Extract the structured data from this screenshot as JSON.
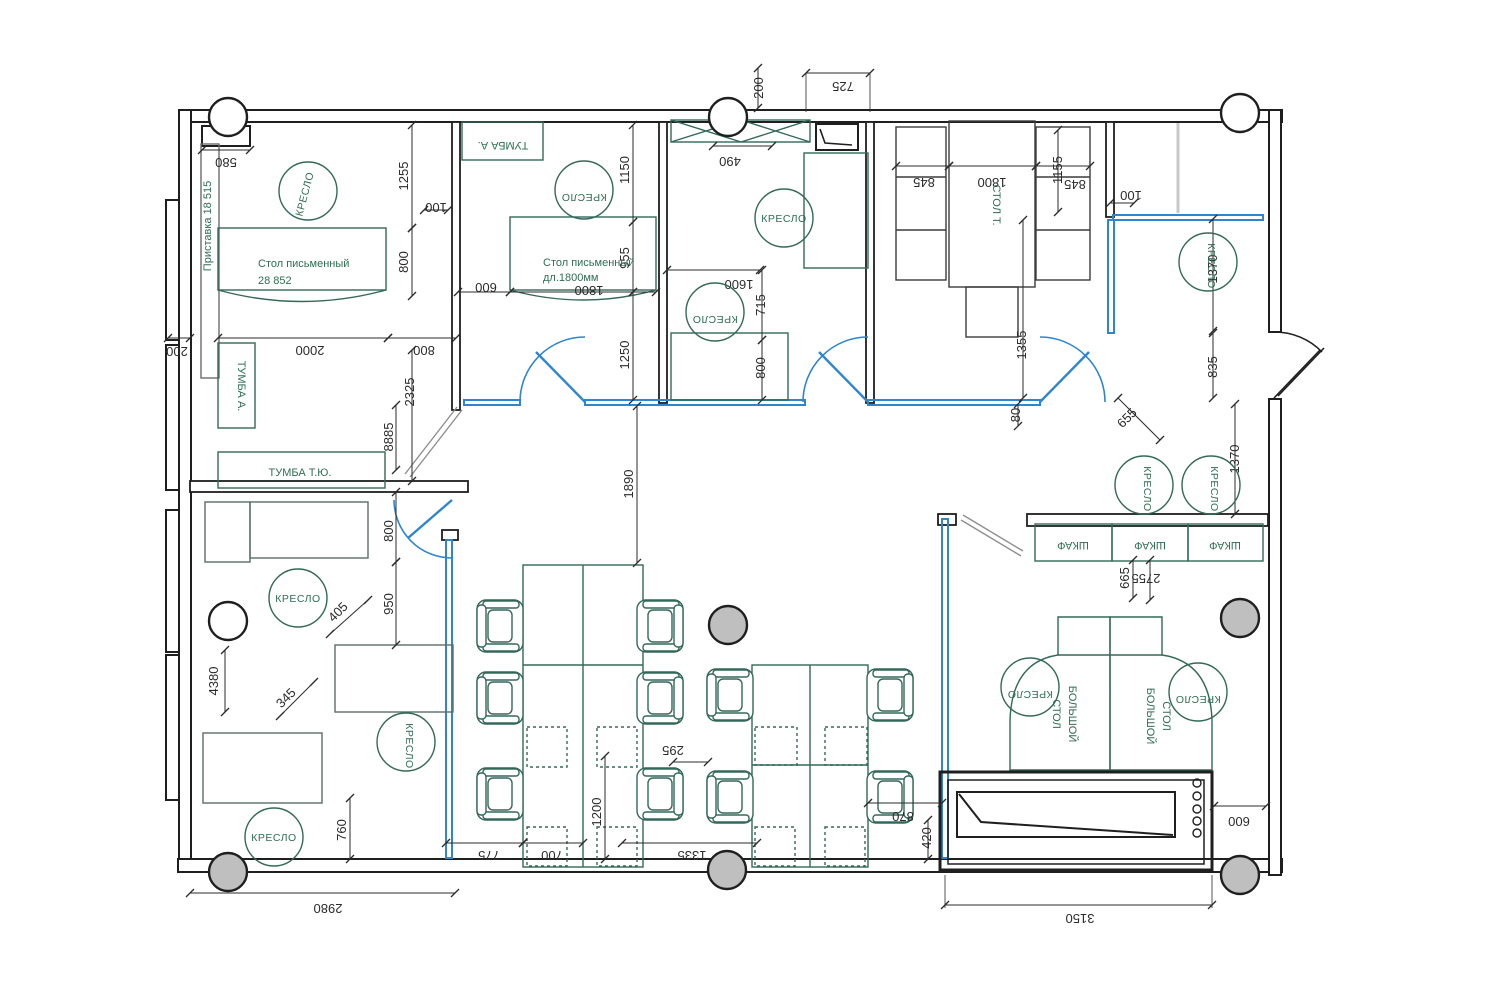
{
  "colors": {
    "wall": "#1f1f1f",
    "partition_blue": "#2f86cf",
    "furniture_green": "#33695a",
    "label_green": "#2f6e54",
    "dim_black": "#2b2b2b",
    "column_gray": "#bfbfbf",
    "light_gray": "#c9c9c9"
  },
  "chair_symbol_label": "КРЕСЛО",
  "chairs": [
    {
      "x": 308,
      "y": 191,
      "rot": -75
    },
    {
      "x": 584,
      "y": 190,
      "rot": 180
    },
    {
      "x": 784,
      "y": 218,
      "rot": 0
    },
    {
      "x": 715,
      "y": 312,
      "rot": 180
    },
    {
      "x": 1208,
      "y": 262,
      "rot": 90
    },
    {
      "x": 1144,
      "y": 485,
      "rot": 90
    },
    {
      "x": 1211,
      "y": 485,
      "rot": 90
    },
    {
      "x": 298,
      "y": 598,
      "rot": 0
    },
    {
      "x": 406,
      "y": 742,
      "rot": 90
    },
    {
      "x": 274,
      "y": 837,
      "rot": 0
    },
    {
      "x": 1030,
      "y": 687,
      "rot": 180
    },
    {
      "x": 1198,
      "y": 692,
      "rot": 180
    }
  ],
  "columns": [
    {
      "x": 228,
      "y": 117,
      "fill": "white"
    },
    {
      "x": 728,
      "y": 117,
      "fill": "white"
    },
    {
      "x": 1240,
      "y": 113,
      "fill": "white"
    },
    {
      "x": 228,
      "y": 621,
      "fill": "white"
    },
    {
      "x": 728,
      "y": 625,
      "fill": "gray"
    },
    {
      "x": 1240,
      "y": 618,
      "fill": "gray"
    },
    {
      "x": 228,
      "y": 872,
      "fill": "gray"
    },
    {
      "x": 727,
      "y": 870,
      "fill": "gray"
    },
    {
      "x": 1240,
      "y": 875,
      "fill": "gray"
    }
  ],
  "labels": [
    {
      "text": "Приставка  18 515",
      "x": 211,
      "y": 226,
      "rot": -90,
      "anchor": "middle"
    },
    {
      "text": "Стол письменный",
      "x": 258,
      "y": 267,
      "rot": 0,
      "anchor": "start"
    },
    {
      "text": "28 852",
      "x": 258,
      "y": 284,
      "rot": 0,
      "anchor": "start"
    },
    {
      "text": "ТУМБА А.",
      "x": 238,
      "y": 386,
      "rot": 90,
      "anchor": "middle"
    },
    {
      "text": "ТУМБА Т.Ю.",
      "x": 300,
      "y": 476,
      "rot": 0,
      "anchor": "middle"
    },
    {
      "text": "ТУМБА А.",
      "x": 503,
      "y": 142,
      "rot": 180,
      "anchor": "middle"
    },
    {
      "text": "Стол письменный",
      "x": 543,
      "y": 266,
      "rot": 0,
      "anchor": "start"
    },
    {
      "text": "дл.1800мм",
      "x": 543,
      "y": 281,
      "rot": 0,
      "anchor": "start"
    },
    {
      "text": "СТОЛ Т.",
      "x": 993,
      "y": 205,
      "rot": 90,
      "anchor": "middle"
    },
    {
      "text": "ШКАФ",
      "x": 1073,
      "y": 542,
      "rot": 180,
      "anchor": "middle"
    },
    {
      "text": "ШКАФ",
      "x": 1150,
      "y": 542,
      "rot": 180,
      "anchor": "middle"
    },
    {
      "text": "ШКАФ",
      "x": 1225,
      "y": 542,
      "rot": 180,
      "anchor": "middle"
    },
    {
      "text": "СТОЛ",
      "x": 1053,
      "y": 714,
      "rot": 90,
      "anchor": "middle"
    },
    {
      "text": "БОЛЬШОЙ",
      "x": 1069,
      "y": 714,
      "rot": 90,
      "anchor": "middle"
    },
    {
      "text": "БОЛЬШОЙ",
      "x": 1147,
      "y": 716,
      "rot": 90,
      "anchor": "middle"
    },
    {
      "text": "СТОЛ",
      "x": 1163,
      "y": 716,
      "rot": 90,
      "anchor": "middle"
    }
  ],
  "dimensions": [
    {
      "t": "580",
      "line": [
        202,
        150,
        250,
        150
      ],
      "lx": 226,
      "ly": 158,
      "rot": 180
    },
    {
      "t": "1255",
      "line": [
        412,
        125,
        412,
        228
      ],
      "lx": 408,
      "ly": 176,
      "rot": -90
    },
    {
      "t": "100",
      "line": [
        424,
        210,
        448,
        210
      ],
      "lx": 436,
      "ly": 203,
      "rot": 180
    },
    {
      "t": "800",
      "line": [
        412,
        228,
        412,
        296
      ],
      "lx": 408,
      "ly": 262,
      "rot": -90
    },
    {
      "t": "2000",
      "line": [
        218,
        338,
        388,
        338
      ],
      "lx": 310,
      "ly": 346,
      "rot": 180
    },
    {
      "t": "800",
      "line": [
        388,
        338,
        456,
        338
      ],
      "lx": 424,
      "ly": 346,
      "rot": 180
    },
    {
      "t": "2325",
      "line": [
        412,
        350,
        412,
        481
      ],
      "lx": 414,
      "ly": 392,
      "rot": -90
    },
    {
      "t": "8885",
      "line": [
        396,
        405,
        396,
        470
      ],
      "lx": 393,
      "ly": 437,
      "rot": -90
    },
    {
      "t": "200",
      "line": [
        168,
        338,
        190,
        338
      ],
      "lx": 177,
      "ly": 347,
      "rot": 180
    },
    {
      "t": "1150",
      "line": [
        633,
        125,
        633,
        222
      ],
      "lx": 629,
      "ly": 170,
      "rot": -90
    },
    {
      "t": "600",
      "line": [
        458,
        292,
        510,
        292
      ],
      "lx": 486,
      "ly": 283,
      "rot": 180
    },
    {
      "t": "1800",
      "line": [
        510,
        292,
        656,
        292
      ],
      "lx": 589,
      "ly": 286,
      "rot": 180
    },
    {
      "t": "955",
      "line": [
        633,
        222,
        633,
        292
      ],
      "lx": 629,
      "ly": 258,
      "rot": -90
    },
    {
      "t": "1250",
      "line": [
        633,
        292,
        633,
        400
      ],
      "lx": 629,
      "ly": 355,
      "rot": -90
    },
    {
      "t": "200",
      "line": [
        758,
        68,
        758,
        108
      ],
      "lx": 763,
      "ly": 88,
      "rot": -90
    },
    {
      "t": "725",
      "line": [
        806,
        73,
        870,
        73
      ],
      "lx": 843,
      "ly": 82,
      "rot": 180
    },
    {
      "t": "490",
      "line": [
        713,
        146,
        772,
        146
      ],
      "lx": 730,
      "ly": 157,
      "rot": 180
    },
    {
      "t": "1600",
      "line": [
        667,
        270,
        760,
        270
      ],
      "lx": 739,
      "ly": 280,
      "rot": 180
    },
    {
      "t": "715",
      "line": [
        762,
        270,
        762,
        340
      ],
      "lx": 765,
      "ly": 305,
      "rot": -90
    },
    {
      "t": "800",
      "line": [
        762,
        340,
        762,
        400
      ],
      "lx": 765,
      "ly": 368,
      "rot": -90
    },
    {
      "t": "845",
      "line": [
        896,
        166,
        949,
        166
      ],
      "lx": 924,
      "ly": 178,
      "rot": 180
    },
    {
      "t": "1800",
      "line": [
        949,
        166,
        1036,
        166
      ],
      "lx": 992,
      "ly": 178,
      "rot": 180
    },
    {
      "t": "845",
      "line": [
        1036,
        166,
        1090,
        166
      ],
      "lx": 1075,
      "ly": 180,
      "rot": 180
    },
    {
      "t": "1155",
      "line": [
        1058,
        130,
        1058,
        212
      ],
      "lx": 1062,
      "ly": 170,
      "rot": -90
    },
    {
      "t": "100",
      "line": [
        1110,
        203,
        1134,
        203
      ],
      "lx": 1131,
      "ly": 191,
      "rot": 180
    },
    {
      "t": "1355",
      "line": [
        1023,
        220,
        1023,
        398
      ],
      "lx": 1026,
      "ly": 345,
      "rot": -90
    },
    {
      "t": "80",
      "line": [
        1018,
        404,
        1018,
        426
      ],
      "lx": 1020,
      "ly": 415,
      "rot": -90
    },
    {
      "t": "1370",
      "line": [
        1213,
        219,
        1213,
        331
      ],
      "lx": 1217,
      "ly": 269,
      "rot": -90
    },
    {
      "t": "835",
      "line": [
        1213,
        333,
        1213,
        398
      ],
      "lx": 1217,
      "ly": 367,
      "rot": -90
    },
    {
      "t": "655",
      "line": [
        1118,
        398,
        1160,
        440
      ],
      "lx": 1130,
      "ly": 421,
      "rot": -45
    },
    {
      "t": "1370",
      "line": [
        1235,
        404,
        1235,
        514
      ],
      "lx": 1239,
      "ly": 459,
      "rot": -90
    },
    {
      "t": "2755",
      "line": [
        1150,
        560,
        1150,
        600
      ],
      "lx": 1146,
      "ly": 574,
      "rot": 180
    },
    {
      "t": "665",
      "line": [
        1133,
        560,
        1133,
        598
      ],
      "lx": 1129,
      "ly": 578,
      "rot": -90
    },
    {
      "t": "1890",
      "line": [
        637,
        406,
        637,
        563
      ],
      "lx": 633,
      "ly": 484,
      "rot": -90
    },
    {
      "t": "800",
      "line": [
        396,
        492,
        396,
        562
      ],
      "lx": 393,
      "ly": 531,
      "rot": -90
    },
    {
      "t": "950",
      "line": [
        396,
        562,
        396,
        645
      ],
      "lx": 393,
      "ly": 604,
      "rot": -90
    },
    {
      "t": "405",
      "line": [
        330,
        634,
        368,
        600
      ],
      "lx": 341,
      "ly": 615,
      "rot": -45
    },
    {
      "t": "345",
      "line": [
        280,
        716,
        314,
        682
      ],
      "lx": 289,
      "ly": 701,
      "rot": -45
    },
    {
      "t": "4380",
      "line": [
        225,
        650,
        225,
        712
      ],
      "lx": 218,
      "ly": 681,
      "rot": -90
    },
    {
      "t": "760",
      "line": [
        350,
        798,
        350,
        859
      ],
      "lx": 346,
      "ly": 830,
      "rot": -90
    },
    {
      "t": "775",
      "line": [
        446,
        843,
        523,
        843
      ],
      "lx": 489,
      "ly": 851,
      "rot": 180
    },
    {
      "t": "700",
      "line": [
        523,
        843,
        583,
        843
      ],
      "lx": 552,
      "ly": 851,
      "rot": 180
    },
    {
      "t": "1200",
      "line": [
        605,
        756,
        605,
        859
      ],
      "lx": 601,
      "ly": 812,
      "rot": -90
    },
    {
      "t": "295",
      "line": [
        673,
        762,
        708,
        762
      ],
      "lx": 673,
      "ly": 746,
      "rot": 180
    },
    {
      "t": "1335",
      "line": [
        622,
        843,
        757,
        843
      ],
      "lx": 692,
      "ly": 851,
      "rot": 180
    },
    {
      "t": "870",
      "line": [
        868,
        803,
        942,
        803
      ],
      "lx": 903,
      "ly": 812,
      "rot": 180
    },
    {
      "t": "420",
      "line": [
        928,
        820,
        928,
        859
      ],
      "lx": 931,
      "ly": 838,
      "rot": -90
    },
    {
      "t": "3150",
      "line": [
        945,
        905,
        1212,
        905
      ],
      "lx": 1080,
      "ly": 914,
      "rot": 180
    },
    {
      "t": "600",
      "line": [
        1214,
        806,
        1266,
        806
      ],
      "lx": 1239,
      "ly": 817,
      "rot": 180
    },
    {
      "t": "2980",
      "line": [
        190,
        893,
        455,
        893
      ],
      "lx": 328,
      "ly": 904,
      "rot": 180
    }
  ]
}
